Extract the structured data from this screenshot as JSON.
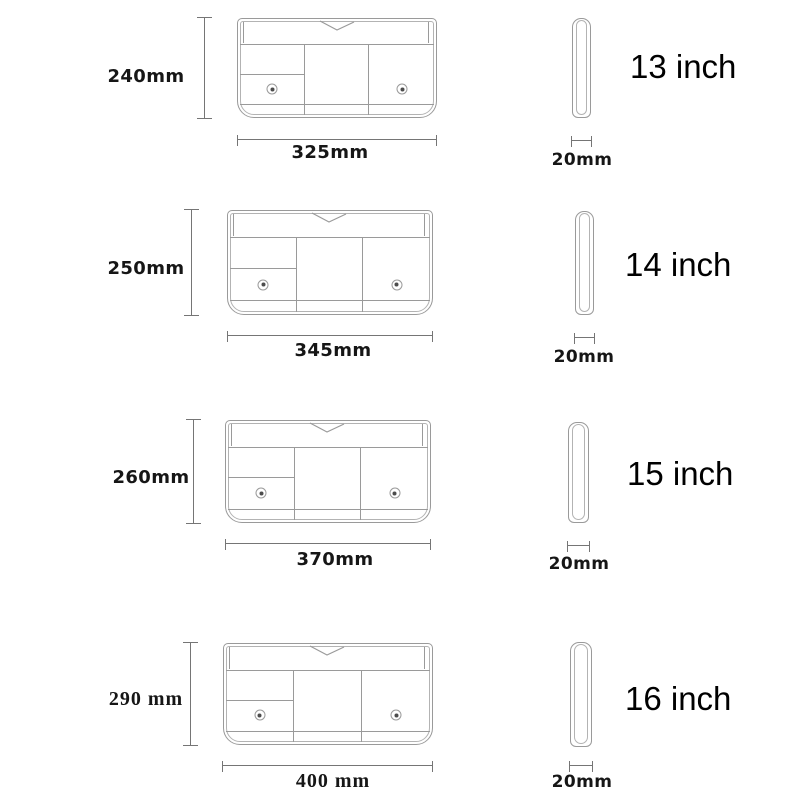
{
  "diagram_title": "laptop-sleeve-size-chart",
  "colors": {
    "background": "#ffffff",
    "outline": "#9a9a9a",
    "outline_inner": "#b3b3b3",
    "dimension_line": "#757575",
    "label_text": "#161616",
    "size_text": "#000000"
  },
  "rows": [
    {
      "device": "13 inch",
      "height": "240mm",
      "width": "325mm",
      "thickness": "20mm"
    },
    {
      "device": "14 inch",
      "height": "250mm",
      "width": "345mm",
      "thickness": "20mm"
    },
    {
      "device": "15 inch",
      "height": "260mm",
      "width": "370mm",
      "thickness": "20mm"
    },
    {
      "device": "16 inch",
      "height": "290 mm",
      "width": "400 mm",
      "thickness": "20mm"
    }
  ]
}
